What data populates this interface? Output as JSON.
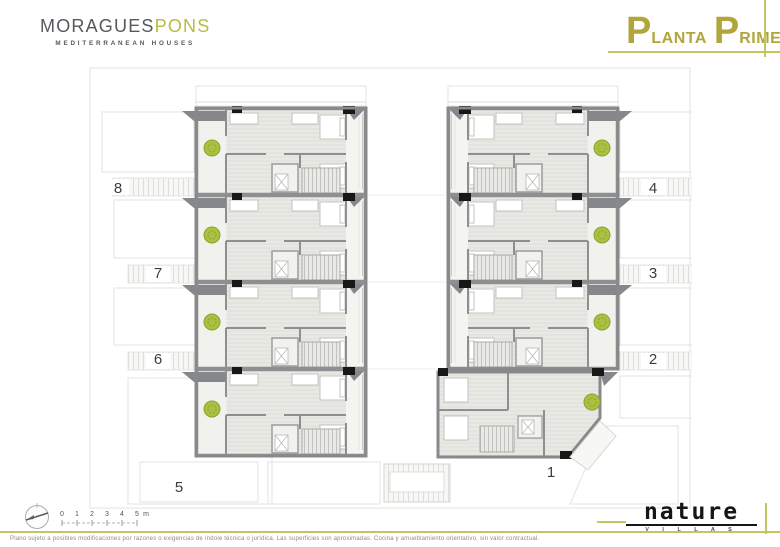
{
  "header": {
    "brand": {
      "part1": "MORAGUES",
      "part2": "PONS",
      "subtitle": "MEDITERRANEAN HOUSES"
    },
    "title": {
      "p1": "P",
      "r1": "LANTA",
      "p2": "P",
      "r2": "RIMERA"
    }
  },
  "plan": {
    "units": [
      {
        "label": "8"
      },
      {
        "label": "7"
      },
      {
        "label": "6"
      },
      {
        "label": "5"
      },
      {
        "label": "4"
      },
      {
        "label": "3"
      },
      {
        "label": "2"
      },
      {
        "label": "1"
      }
    ]
  },
  "scalebar": {
    "ticks": [
      "0",
      "1",
      "2",
      "3",
      "4",
      "5"
    ],
    "unit": "m"
  },
  "footer": {
    "disclaimer": "Plano sujeto a posibles modificaciones por razones o exigencias de índole técnica o jurídica. Las superficies son aproximadas. Cocina y amueblamiento orientativo, sin valor contractual.",
    "logo": {
      "name": "nature",
      "sub": "V I L L A S"
    }
  },
  "colors": {
    "accent_olive": "#c1c75e",
    "title_gold": "#b1a53b",
    "brand_gray": "#55595d",
    "wall_gray": "#8d8f91",
    "plant_green": "#a9c140"
  }
}
